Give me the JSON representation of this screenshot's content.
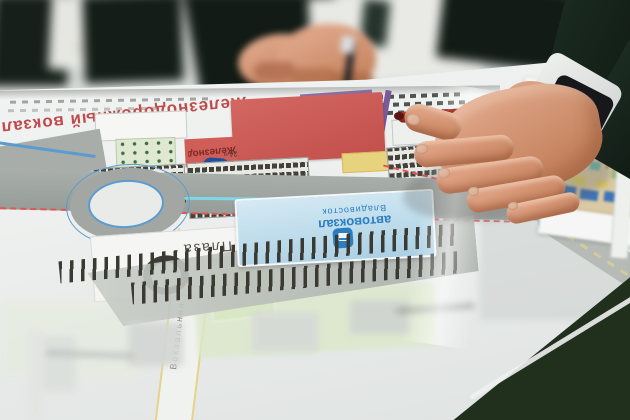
{
  "scene": {
    "type": "photograph",
    "description": "Businessmen at a dark green table reviewing a printed urban master plan of a railway station area; a hand with a wristwatch points at the plan",
    "objects": [
      "left-person-suit",
      "center-person-suit",
      "blurred-hands-with-pen",
      "pointing-hand",
      "wristwatch",
      "red-marker-pen",
      "master-plan-sheet",
      "secondary-plan-sheet",
      "table-surface"
    ]
  },
  "map": {
    "station_label": "Железнодорожный вокзал",
    "hours_label": "24 ч",
    "bus_station_label": "автовокзал",
    "bus_city_label": "Владивосток",
    "plaza_label": "Плаза",
    "street_label": "Вокзальная",
    "icons": {
      "bus": "bus-icon",
      "transit": "transit-station-icon",
      "plaza_logo": "plaza-ring-logo"
    }
  },
  "colors": {
    "table_green": "#31452f",
    "suit_dark": "#15231b",
    "shirt_white": "#e9eae7",
    "skin": "#d09478",
    "paper": "#eff1f0",
    "station_building_red": "#cd5a55",
    "station_text_red": "#bf4a4a",
    "bus_roof_blue": "#b5d9ea",
    "transit_blue": "#2b7ec2",
    "road_gray": "#a0a5a2",
    "park_green": "#d8e6c4",
    "rail_dark": "#3c3c34",
    "route_red_dashed": "#e05252",
    "yellow_road_edge": "#e6d28a",
    "purple_line": "#7a5a98",
    "cyan_line": "#7fd8e6"
  }
}
